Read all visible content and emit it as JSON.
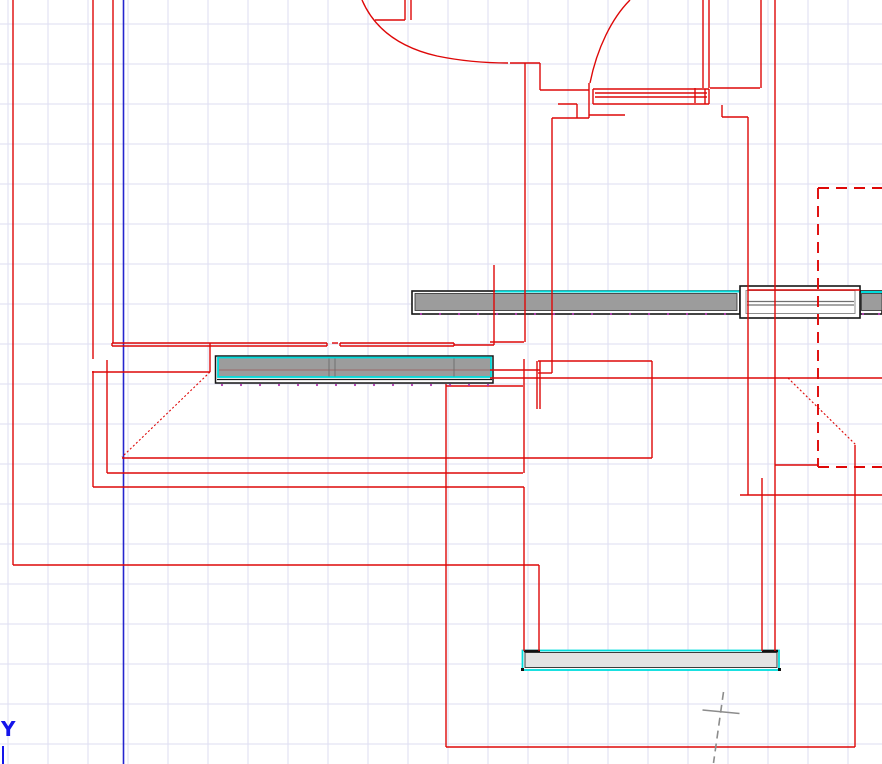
{
  "canvas": {
    "w": 882,
    "h": 764,
    "background": "#ffffff"
  },
  "grid": {
    "spacing": 40,
    "x_offset": 8,
    "y_offset": 24,
    "color": "#deddf2"
  },
  "axis": {
    "label": "Y",
    "label_color": "#1414ea",
    "label_x": 1,
    "label_y": 736,
    "label_size": 20,
    "line_color": "#2525cf",
    "vertical_line_x": 123.5,
    "origin_tick": {
      "x": 3,
      "y1": 746,
      "y2": 764
    }
  },
  "colors": {
    "wall": "#de0808",
    "cyan": "#00dcdc",
    "bar_gray": "#9c9c9c",
    "bar_light": "#e3e3e3",
    "black": "#161616",
    "frame_gray": "#8f8f8f",
    "mid_gray": "#707070",
    "mullion": "#9a6868",
    "dot": "#b03ab0",
    "cross": "#8c8c8c",
    "white": "#ffffff"
  },
  "walls": {
    "solid": [
      [
        13,
        0,
        13,
        565
      ],
      [
        13,
        565,
        539,
        565
      ],
      [
        93,
        0,
        93,
        359
      ],
      [
        93,
        371,
        93,
        487
      ],
      [
        93,
        487,
        524,
        487
      ],
      [
        113,
        0,
        113,
        343
      ],
      [
        107,
        360,
        107,
        473
      ],
      [
        107,
        473,
        523,
        473
      ],
      [
        92,
        372,
        210,
        372
      ],
      [
        210,
        343,
        210,
        372
      ],
      [
        112,
        343,
        112,
        346
      ],
      [
        112,
        343,
        327,
        343
      ],
      [
        112,
        346,
        327,
        346
      ],
      [
        327,
        343,
        327,
        346
      ],
      [
        332,
        343,
        338,
        343
      ],
      [
        340,
        343,
        340,
        346
      ],
      [
        340,
        343,
        454,
        343
      ],
      [
        340,
        346,
        454,
        346
      ],
      [
        454,
        343,
        454,
        346
      ],
      [
        454,
        345,
        494,
        345
      ],
      [
        490,
        342,
        524,
        342
      ],
      [
        494,
        265,
        494,
        345
      ],
      [
        525,
        63,
        525,
        342
      ],
      [
        552,
        118,
        552,
        373
      ],
      [
        538,
        373,
        552,
        373
      ],
      [
        510,
        63,
        540,
        63
      ],
      [
        540,
        63,
        540,
        90
      ],
      [
        540,
        90,
        589,
        90
      ],
      [
        589,
        83,
        589,
        118
      ],
      [
        552,
        118,
        589,
        118
      ],
      [
        589,
        115,
        625,
        115
      ],
      [
        577,
        104,
        577,
        118
      ],
      [
        558,
        104,
        577,
        104
      ],
      [
        375,
        20,
        405,
        20
      ],
      [
        405,
        0,
        405,
        20
      ],
      [
        411,
        0,
        411,
        20
      ],
      [
        703,
        0,
        703,
        88
      ],
      [
        709,
        0,
        709,
        88
      ],
      [
        710,
        88,
        760,
        88
      ],
      [
        761,
        0,
        761,
        88
      ],
      [
        775,
        0,
        775,
        651
      ],
      [
        722,
        105,
        722,
        117
      ],
      [
        722,
        117,
        748,
        117
      ],
      [
        748,
        117,
        748,
        495
      ],
      [
        740,
        495,
        882,
        495
      ],
      [
        775,
        465,
        818,
        465
      ],
      [
        490,
        370,
        540,
        370
      ],
      [
        490,
        378,
        882,
        378
      ],
      [
        446,
        386,
        523,
        386
      ],
      [
        538,
        361,
        652,
        361
      ],
      [
        652,
        361,
        652,
        458
      ],
      [
        122,
        458,
        652,
        458
      ],
      [
        537,
        361,
        537,
        409
      ],
      [
        540,
        361,
        540,
        409
      ],
      [
        524,
        359,
        524,
        473
      ],
      [
        524,
        487,
        524,
        651
      ],
      [
        539,
        565,
        539,
        651
      ],
      [
        762,
        478,
        762,
        651
      ],
      [
        446,
        384,
        446,
        747
      ],
      [
        446,
        747,
        855,
        747
      ],
      [
        855,
        445,
        855,
        747
      ],
      [
        593,
        89,
        593,
        104
      ],
      [
        709,
        89,
        709,
        104
      ],
      [
        593,
        89,
        709,
        89
      ],
      [
        593,
        104,
        709,
        104
      ],
      [
        595,
        93,
        707,
        93
      ],
      [
        595,
        97,
        707,
        97
      ],
      [
        695,
        88,
        695,
        103
      ],
      [
        705,
        89,
        705,
        104
      ],
      [
        748,
        290,
        860,
        290
      ]
    ],
    "dotted": [
      [
        210,
        372,
        122,
        457
      ],
      [
        788,
        378,
        856,
        445
      ]
    ],
    "dashed": [
      [
        818,
        188,
        882,
        188
      ],
      [
        818,
        188,
        818,
        467
      ],
      [
        818,
        467,
        882,
        467
      ]
    ],
    "arcs": [
      "M 362 0 C 374 28 398 47 437 56 C 466 62 490 63 508 63",
      "M 630 0 C 612 18 597 48 590 83"
    ]
  },
  "fixtures": [
    {
      "shape": "rect",
      "name": "big-window-bar-outline",
      "x": 412,
      "y": 291,
      "w": 328,
      "h": 23,
      "fill": "#ffffff",
      "stroke": "#161616",
      "sw": 1.6
    },
    {
      "shape": "rect",
      "name": "big-window-bar-fill",
      "x": 415,
      "y": 293.5,
      "w": 322,
      "h": 17,
      "fill": "#9c9c9c",
      "stroke": "#2c2c2c",
      "sw": 0.8
    },
    {
      "shape": "line",
      "name": "big-window-cyan-edge",
      "x1": 495,
      "y1": 291.5,
      "x2": 740,
      "y2": 291.5,
      "stroke": "#00dcdc",
      "sw": 2
    },
    {
      "shape": "rect",
      "name": "right-window-bar-outline",
      "x": 860,
      "y": 291,
      "w": 22,
      "h": 23,
      "fill": "#ffffff",
      "stroke": "#161616",
      "sw": 1.6
    },
    {
      "shape": "rect",
      "name": "right-window-bar-fill",
      "x": 861.5,
      "y": 293.5,
      "w": 20.5,
      "h": 17,
      "fill": "#9c9c9c",
      "stroke": "#2c2c2c",
      "sw": 0.8
    },
    {
      "shape": "line",
      "name": "right-window-cyan-edge",
      "x1": 861,
      "y1": 292,
      "x2": 882,
      "y2": 292,
      "stroke": "#00dcdc",
      "sw": 2
    },
    {
      "shape": "rect",
      "name": "cased-opening-frame",
      "x": 740,
      "y": 286,
      "w": 120,
      "h": 32,
      "fill": "#ffffff",
      "stroke": "#161616",
      "sw": 1.6
    },
    {
      "shape": "rect",
      "name": "cased-opening-inner",
      "x": 746,
      "y": 290.5,
      "w": 109,
      "h": 23,
      "fill": "none",
      "stroke": "#8f8f8f",
      "sw": 1
    },
    {
      "shape": "line",
      "name": "cased-opening-mid-line",
      "x1": 747,
      "y1": 301.5,
      "x2": 854,
      "y2": 301.5,
      "stroke": "#707070",
      "sw": 1.2
    },
    {
      "shape": "line",
      "name": "cased-opening-mid-line",
      "x1": 747,
      "y1": 305,
      "x2": 854,
      "y2": 305,
      "stroke": "#707070",
      "sw": 1.2
    },
    {
      "shape": "rect",
      "name": "left-window-bar-outline",
      "x": 215.5,
      "y": 356,
      "w": 277.5,
      "h": 27,
      "fill": "#ffffff",
      "stroke": "#161616",
      "sw": 1.5
    },
    {
      "shape": "line",
      "name": "left-window-bar-inner-edge",
      "x1": 217,
      "y1": 379.5,
      "x2": 492,
      "y2": 379.5,
      "stroke": "#161616",
      "sw": 1.2
    },
    {
      "shape": "rect",
      "name": "left-window-bar-fill",
      "x": 218,
      "y": 357.5,
      "w": 273,
      "h": 19.5,
      "fill": "#9c9c9c",
      "stroke": "#00dcdc",
      "sw": 1.8
    },
    {
      "shape": "line",
      "name": "left-window-mullion",
      "x1": 219,
      "y1": 370,
      "x2": 490,
      "y2": 370,
      "stroke": "#9a6868",
      "sw": 1
    },
    {
      "shape": "line",
      "name": "left-window-divider",
      "x1": 329,
      "y1": 358.5,
      "x2": 329,
      "y2": 376.5,
      "stroke": "#6f6f6f",
      "sw": 1
    },
    {
      "shape": "line",
      "name": "left-window-divider",
      "x1": 335,
      "y1": 358.5,
      "x2": 335,
      "y2": 376.5,
      "stroke": "#6f6f6f",
      "sw": 1
    },
    {
      "shape": "line",
      "name": "left-window-divider",
      "x1": 454,
      "y1": 358.5,
      "x2": 454,
      "y2": 376.5,
      "stroke": "#6f6f6f",
      "sw": 1
    },
    {
      "shape": "rect",
      "name": "bottom-sill-outline",
      "x": 522.5,
      "y": 650.5,
      "w": 256.5,
      "h": 19.5,
      "fill": "#ffffff",
      "stroke": "#00dcdc",
      "sw": 1.8
    },
    {
      "shape": "rect",
      "name": "bottom-sill-fill",
      "x": 525,
      "y": 652.5,
      "w": 252,
      "h": 15,
      "fill": "#e3e3e3",
      "stroke": "#3c3c3c",
      "sw": 1
    },
    {
      "shape": "line",
      "name": "bottom-sill-black-seg",
      "x1": 524,
      "y1": 651,
      "x2": 540,
      "y2": 651,
      "stroke": "#111111",
      "sw": 2.5
    },
    {
      "shape": "line",
      "name": "bottom-sill-black-seg",
      "x1": 762,
      "y1": 651,
      "x2": 778,
      "y2": 651,
      "stroke": "#111111",
      "sw": 2.5
    },
    {
      "shape": "rect",
      "name": "bottom-sill-corner",
      "x": 521,
      "y": 668,
      "w": 3,
      "h": 3,
      "fill": "#111111",
      "stroke": "none",
      "sw": 0
    },
    {
      "shape": "rect",
      "name": "bottom-sill-corner",
      "x": 778,
      "y": 668,
      "w": 3,
      "h": 3,
      "fill": "#111111",
      "stroke": "none",
      "sw": 0
    }
  ],
  "tick_dot_rows": [
    {
      "y": 314,
      "x1": 421,
      "x2": 737,
      "step": 19
    },
    {
      "y": 314,
      "x1": 863,
      "x2": 879,
      "step": 16
    },
    {
      "y": 385,
      "x1": 222,
      "x2": 488,
      "step": 19
    }
  ],
  "survey_cross": {
    "lines": [
      {
        "x1": 702.5,
        "y1": 710,
        "x2": 739.5,
        "y2": 713.5,
        "dash": ""
      },
      {
        "x1": 723.5,
        "y1": 692,
        "x2": 713.5,
        "y2": 763,
        "dash": "8 5"
      }
    ]
  }
}
